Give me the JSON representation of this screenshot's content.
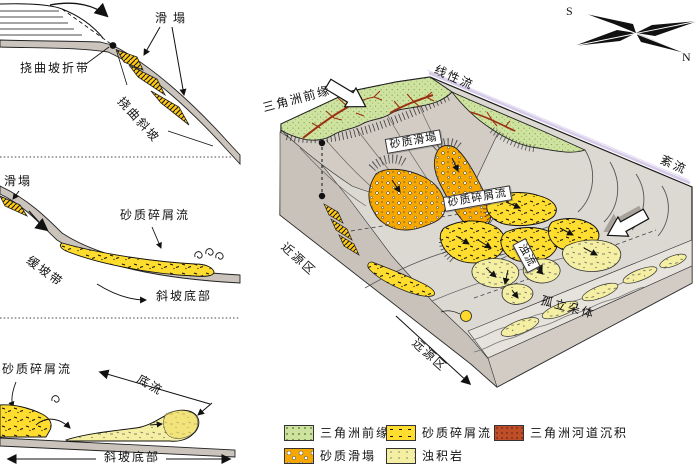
{
  "panels": {
    "p1": {
      "flexure_break_label": "挠曲坡折带",
      "slump_label": "滑塌",
      "flexure_slope_label": "挠曲斜坡"
    },
    "p2": {
      "slump_label": "滑塌",
      "sandy_debris_flow_label": "砂质碎屑流",
      "gentle_slope_label": "缓坡带",
      "slope_bottom_label": "斜坡底部"
    },
    "p3": {
      "sandy_debris_flow_label": "砂质碎屑流",
      "bottom_current_label": "底流",
      "slope_bottom_label": "斜坡底部"
    }
  },
  "block": {
    "delta_front_label": "三角洲前缘",
    "linear_flow_label": "线性流",
    "turbulent_flow_label": "紊流",
    "sandy_slump_label": "砂质滑塌",
    "sandy_debris_flow_label": "砂质碎屑流",
    "turbidity_current_label": "浊流",
    "isolated_lobes_label": "孤立朵体",
    "proximal_area_label": "近源区",
    "distal_area_label": "远源区"
  },
  "compass": {
    "south_label": "S",
    "north_label": "N"
  },
  "legend": {
    "items": [
      {
        "label": "三角洲前缘",
        "color": "#cfe3a0"
      },
      {
        "label": "砂质碎屑流",
        "color": "#ffdd2e"
      },
      {
        "label": "三角洲河道沉积",
        "color": "#bf4e28"
      },
      {
        "label": "砂质滑塌",
        "color": "#f6a800"
      },
      {
        "label": "浊积岩",
        "color": "#f5efa3"
      }
    ]
  },
  "colors": {
    "delta_front_green": "#cfe3a0",
    "sandy_debris_yellow": "#ffdd2e",
    "channel_red": "#bf4e28",
    "sandy_slump_orange": "#f6a800",
    "turbidite_pale": "#f5efa3",
    "waterline_lavender": "#d5cae8",
    "slope_grey": "#cbc4bd"
  }
}
